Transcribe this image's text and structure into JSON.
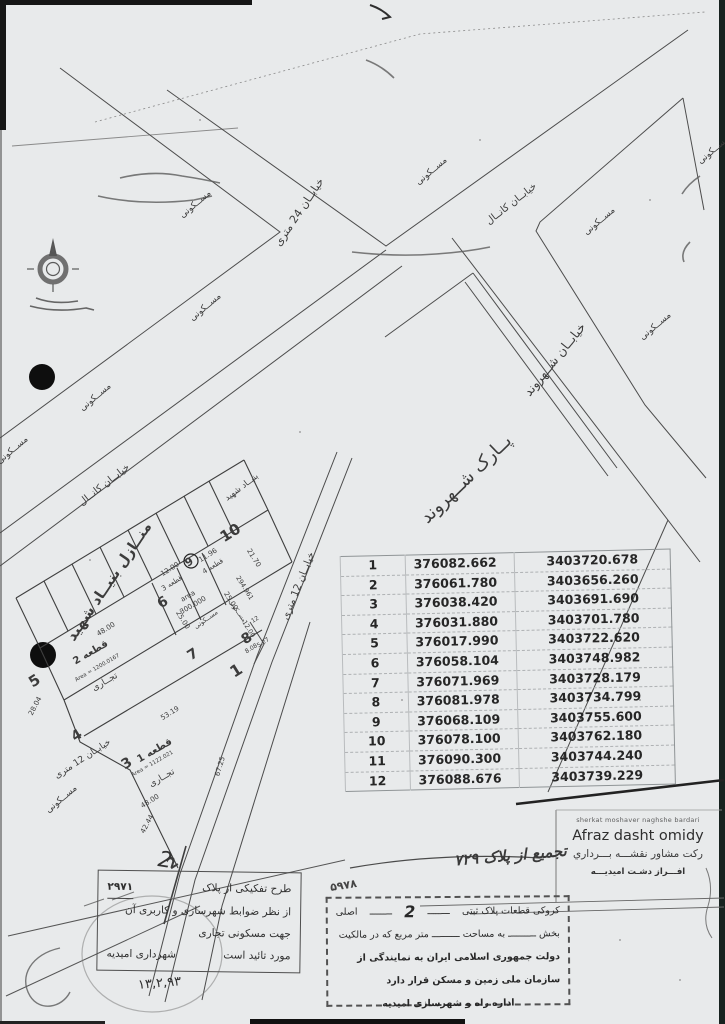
{
  "page": {
    "bg": "#e8eaeb"
  },
  "coord_table": {
    "rows": [
      [
        "1",
        "376082.662",
        "3403720.678"
      ],
      [
        "2",
        "376061.780",
        "3403656.260"
      ],
      [
        "3",
        "376038.420",
        "3403691.690"
      ],
      [
        "4",
        "376031.880",
        "3403701.780"
      ],
      [
        "5",
        "376017.990",
        "3403722.620"
      ],
      [
        "6",
        "376058.104",
        "3403748.982"
      ],
      [
        "7",
        "376071.969",
        "3403728.179"
      ],
      [
        "8",
        "376081.978",
        "3403734.799"
      ],
      [
        "9",
        "376068.109",
        "3403755.600"
      ],
      [
        "10",
        "376078.100",
        "3403762.180"
      ],
      [
        "11",
        "376090.300",
        "3403744.240"
      ],
      [
        "12",
        "376088.676",
        "3403739.229"
      ]
    ]
  },
  "map": {
    "streets": {
      "s24": "خیابــان 24 متری",
      "kanal": "خیابــان کانــال",
      "shahrvand": "خیابــان شــهروند",
      "s12": "خیابــان 12 متری",
      "park": "پــارک شــهروند"
    },
    "zones": {
      "maskooni": "مســکونی",
      "bonyad": "بنیــاد شهید",
      "manazel": "منــازل بنیــاد شهید",
      "tejari": "تجــاری"
    },
    "plots": {
      "p1": "قطعه 1",
      "p2": "قطعه 2",
      "p3": "قطعه 3",
      "p4": "قطعه 4",
      "area1": "Area = 1122.021",
      "area2": "Area = 1200.0167",
      "area3a": "area",
      "area3b": "300.000",
      "area5": "294.961"
    },
    "dims": {
      "d48": "48.00",
      "d53": "53.19",
      "d42": "42.44",
      "d28": "28.04",
      "d25": "25.00",
      "d12": "12.00",
      "d11": "11.96",
      "d21": "21.70",
      "d8": "8.08",
      "d5": "5.27",
      "d67": "67.25",
      "d12b": "12"
    },
    "points": {
      "n1": "1",
      "n2": "2",
      "n3": "3",
      "n4": "4",
      "n5": "5",
      "n6": "6",
      "n7": "7",
      "n8": "8",
      "n9": "9",
      "n10": "10"
    }
  },
  "stamps": {
    "afraz": {
      "l1": "sherkat moshaver naghshe bardari",
      "l2": "Afraz dasht omidy",
      "l3": "رکت مشاور نقشـــه بـــرداري",
      "l4": "افـــراز دشـت امیدیـــه"
    },
    "tafkik": {
      "l1": "طرح تفکیکی از پلاک",
      "num": "۲۹۷۱",
      "l2": "از نظر ضوابط شهرسازی و کاربری آن",
      "l3": "جهت مسکونی تجاری",
      "l4a": "مورد تائید است",
      "l4b": "شهرداری امیدیه",
      "date": "۱۳,۲,۹۳",
      "scrawl": "2"
    },
    "kroki": {
      "r1a": "کروکی قطعات پلاک ثبتی",
      "dash": "ــــــــ",
      "r1num": "2",
      "r1b": "اصلی",
      "r2": "بخش ــــــــــ به مساحت ــــــــــ متر مربع که در مالکیت",
      "r3": "دولت جمهوری اسلامی ایران به نمایندگی از سازمان ملی زمین و مسکن قرار دارد",
      "r4": "اداره راه و شهرسازی امیدیه",
      "hw1": "تجمیع از پلاک ۷۲۹",
      "hw2": "۵۹۷۸"
    }
  }
}
